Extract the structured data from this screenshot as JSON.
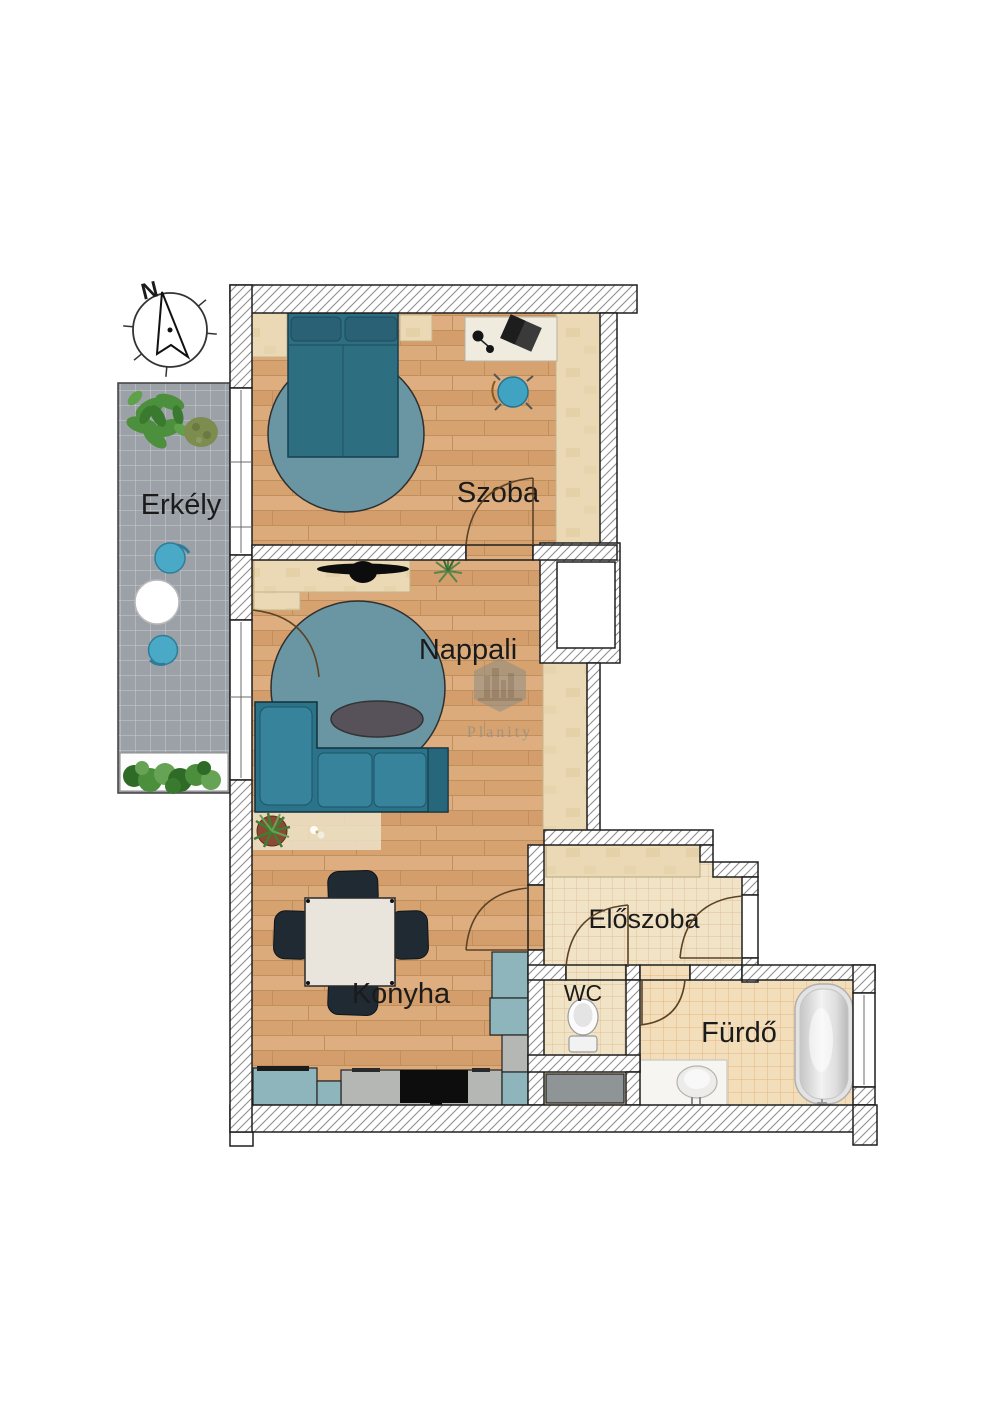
{
  "compass": {
    "north_label": "N"
  },
  "rooms": {
    "balcony": {
      "label": "Erkély"
    },
    "bedroom": {
      "label": "Szoba"
    },
    "living_room": {
      "label": "Nappali"
    },
    "kitchen": {
      "label": "Konyha"
    },
    "hallway": {
      "label": "Előszoba"
    },
    "wc": {
      "label": "WC"
    },
    "bathroom": {
      "label": "Fürdő"
    }
  },
  "watermark": {
    "brand": "Planity"
  },
  "colors": {
    "wall_hatch_line": "#8f8f8f",
    "wood_floor": "#d9a877",
    "pale_wood": "#ead9b4",
    "hall_tile": "#f1e3c6",
    "bath_tile": "#f3debb",
    "balcony_tile": "#9ba1a7",
    "teal_furniture": "#2b7389",
    "rug_teal": "#6996a2",
    "chair_blue": "#41a3c2",
    "kitchen_cabinet": "#8fb5bc",
    "counter_gray": "#b4b7b3",
    "dark_chair": "#1f2a33"
  }
}
